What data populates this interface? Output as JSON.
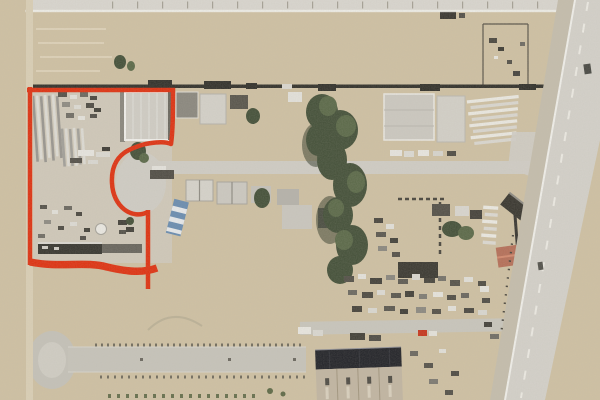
{
  "image": {
    "kind": "satellite-aerial-photo",
    "subject": "industrial storage yard with outlined land parcel",
    "width": 600,
    "height": 400
  },
  "colors": {
    "annotation-red": "#de3414",
    "dirt-tan": "#cec0a3",
    "field-light": "#d3c6aa",
    "orchard-ground": "#c9c5b5",
    "brown-dirt": "#bfae90",
    "scrub-base": "#77715e",
    "scrub-roadside": "#6e6955",
    "concrete": "#bcb9b1",
    "concrete-light": "#cfccc4",
    "road-pale": "#d3d0c9",
    "gravel": "#c4bdac",
    "tree-green": "#46523b",
    "tree-highlight": "#5c6a4a",
    "roof-dark": "#25262b",
    "warehouse-tan": "#c1b5a2",
    "fence-dark": "#34332d",
    "line-white": "#efeee9"
  },
  "annotation": {
    "name": "parcel-boundary",
    "color": "#de3414",
    "stroke_width": 4.5,
    "bottom_stroke_width": 7.5,
    "paths": {
      "left_edge": "M30,87 L30,265",
      "top_edge": "M27,90 L175,90",
      "right_edge_and_bulb": "M173,88 C173,110 173,130 171,144 C165,141 148,142 136,147 C118,153 111,165 112,183 C113,207 132,220 148,212",
      "south_tail": "M148,210 L148,289",
      "bottom_edge": "M30,262 C60,268 85,261 107,267 C128,272 143,273 157,268"
    }
  }
}
